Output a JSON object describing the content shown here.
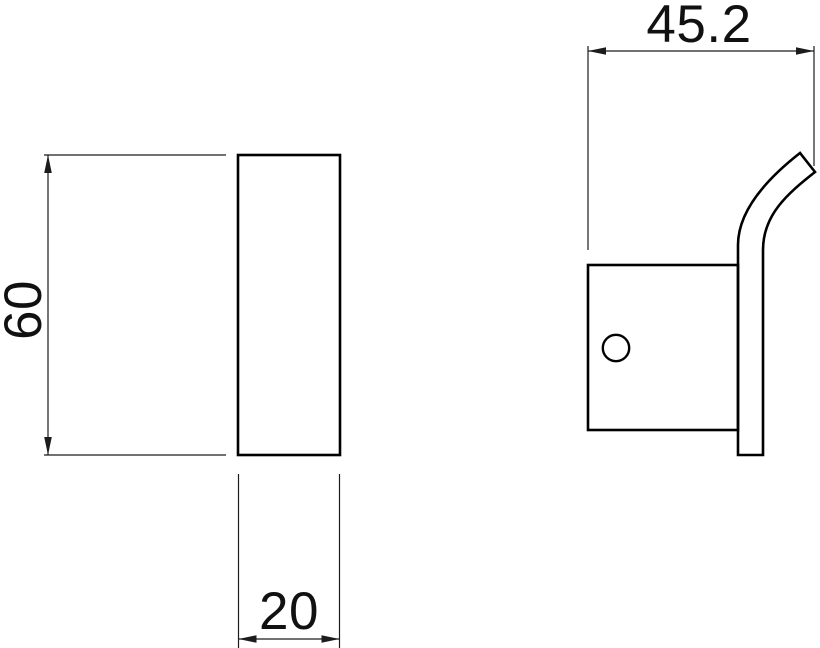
{
  "drawing": {
    "colors": {
      "background": "#ffffff",
      "object_line": "#000000",
      "dimension_line": "#1c1c1c",
      "text": "#111111"
    },
    "dimensions": {
      "height": {
        "label": "60"
      },
      "width": {
        "label": "20"
      },
      "depth": {
        "label": "45.2"
      }
    }
  }
}
